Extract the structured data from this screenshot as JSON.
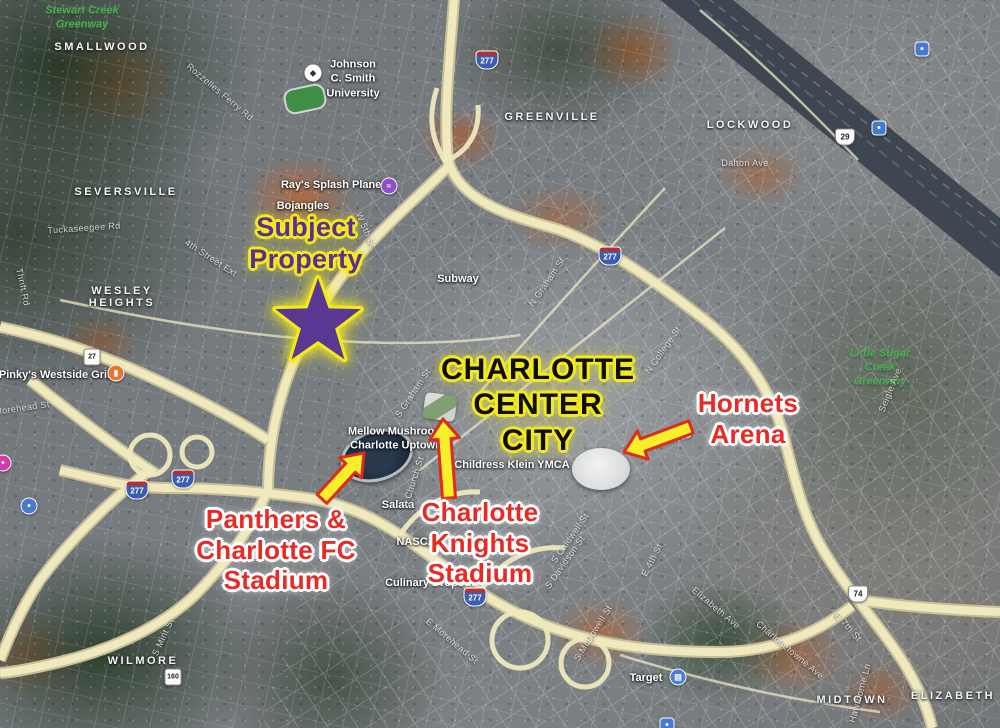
{
  "map_type": "satellite",
  "title_annotations": {
    "subject_property": {
      "text": "Subject\nProperty",
      "color": "#5b2f91",
      "outline": "#f2ea1b"
    },
    "center_city": {
      "text": "CHARLOTTE\nCENTER\nCITY",
      "color": "#0e0e0e",
      "outline": "#f2ea1b"
    },
    "hornets": {
      "text": "Hornets\nArena",
      "color": "#e92a24",
      "outline": "#ffffff"
    },
    "panthers": {
      "text": "Panthers &\nCharlotte FC\nStadium",
      "color": "#e92a24",
      "outline": "#ffffff"
    },
    "knights": {
      "text": "Charlotte\nKnights\nStadium",
      "color": "#e92a24",
      "outline": "#ffffff"
    },
    "star_color": "#5b3794",
    "arrow_fill": "#f7ef29",
    "arrow_outline": "#dd2b1e"
  },
  "star": {
    "cx": 318,
    "cy": 323,
    "outer": 45,
    "inner": 18
  },
  "arrows": [
    {
      "name": "panthers-arrow",
      "from": [
        322,
        499
      ],
      "to": [
        364,
        453
      ]
    },
    {
      "name": "knights-arrow",
      "from": [
        449,
        498
      ],
      "to": [
        443,
        419
      ]
    },
    {
      "name": "hornets-arrow",
      "from": [
        691,
        427
      ],
      "to": [
        624,
        452
      ]
    }
  ],
  "neighborhoods": [
    {
      "label": "SMALLWOOD",
      "x": 102,
      "y": 47
    },
    {
      "label": "SEVERSVILLE",
      "x": 126,
      "y": 192
    },
    {
      "label": "WESLEY\nHEIGHTS",
      "x": 122,
      "y": 297
    },
    {
      "label": "GREENVILLE",
      "x": 552,
      "y": 117
    },
    {
      "label": "LOCKWOOD",
      "x": 750,
      "y": 125
    },
    {
      "label": "WILMORE",
      "x": 143,
      "y": 661
    },
    {
      "label": "MIDTOWN",
      "x": 852,
      "y": 700
    },
    {
      "label": "ELIZABETH",
      "x": 953,
      "y": 696
    }
  ],
  "parks": [
    {
      "label": "Stewart Creek\nGreenway",
      "x": 82,
      "y": 18
    },
    {
      "label": "Little Sugar\nCreek\nGreenway",
      "x": 880,
      "y": 368
    }
  ],
  "pois": [
    {
      "label": "Johnson\nC. Smith\nUniversity",
      "x": 353,
      "y": 79,
      "icon": "graduation-cap",
      "icon_x": 313,
      "icon_y": 73
    },
    {
      "label": "Ray's Splash Planet",
      "x": 333,
      "y": 185,
      "icon": "swim",
      "icon_x": 389,
      "icon_y": 186
    },
    {
      "label": "Bojangles",
      "x": 303,
      "y": 206
    },
    {
      "label": "Subway",
      "x": 458,
      "y": 279
    },
    {
      "label": "Pinky's Westside Grill",
      "x": 56,
      "y": 375,
      "icon": "restaurant",
      "icon_x": 116,
      "icon_y": 373
    },
    {
      "label": "Mellow Mushroom\nCharlotte Uptown",
      "x": 396,
      "y": 439
    },
    {
      "label": "Childress Klein YMCA",
      "x": 512,
      "y": 465
    },
    {
      "label": "Salata",
      "x": 398,
      "y": 505
    },
    {
      "label": "NASCAR",
      "x": 420,
      "y": 542
    },
    {
      "label": "Culinary Dropout",
      "x": 430,
      "y": 583
    },
    {
      "label": "Target",
      "x": 646,
      "y": 678,
      "icon": "shopping",
      "icon_x": 678,
      "icon_y": 677
    }
  ],
  "streets": [
    {
      "label": "Rozzelles Ferry Rd",
      "x": 220,
      "y": 92,
      "rot": 40
    },
    {
      "label": "Tuckaseegee Rd",
      "x": 84,
      "y": 228,
      "rot": -4
    },
    {
      "label": "Thrift Rd",
      "x": 23,
      "y": 287,
      "rot": 78
    },
    {
      "label": "4th Street Ext",
      "x": 211,
      "y": 258,
      "rot": 33
    },
    {
      "label": "W 5th St",
      "x": 366,
      "y": 230,
      "rot": 66
    },
    {
      "label": "N Graham St",
      "x": 547,
      "y": 282,
      "rot": -56
    },
    {
      "label": "S Graham St",
      "x": 413,
      "y": 393,
      "rot": -56
    },
    {
      "label": "N College St",
      "x": 663,
      "y": 350,
      "rot": -55
    },
    {
      "label": "S Church St",
      "x": 413,
      "y": 482,
      "rot": -72
    },
    {
      "label": "Morehead St",
      "x": 22,
      "y": 408,
      "rot": -8
    },
    {
      "label": "S Caldwell St",
      "x": 570,
      "y": 538,
      "rot": -55
    },
    {
      "label": "S Davidson St",
      "x": 565,
      "y": 562,
      "rot": -55
    },
    {
      "label": "E 4th St",
      "x": 652,
      "y": 560,
      "rot": -62
    },
    {
      "label": "S Mint St",
      "x": 163,
      "y": 637,
      "rot": -65
    },
    {
      "label": "E Morehead St",
      "x": 452,
      "y": 641,
      "rot": 40
    },
    {
      "label": "S McDowell St",
      "x": 593,
      "y": 633,
      "rot": -58
    },
    {
      "label": "Elizabeth Ave",
      "x": 716,
      "y": 608,
      "rot": 40
    },
    {
      "label": "Charlottetowne Ave",
      "x": 790,
      "y": 650,
      "rot": 40
    },
    {
      "label": "E 7th St",
      "x": 848,
      "y": 627,
      "rot": 48
    },
    {
      "label": "Hawthorne Ln",
      "x": 860,
      "y": 693,
      "rot": -75
    },
    {
      "label": "Dalton Ave",
      "x": 745,
      "y": 163,
      "rot": 0
    },
    {
      "label": "Seigle Ave",
      "x": 890,
      "y": 390,
      "rot": -68
    },
    {
      "label": "BREVARD",
      "x": 665,
      "y": 442,
      "rot": -16,
      "big": true
    }
  ],
  "shields": [
    {
      "type": "i",
      "label": "277",
      "x": 610,
      "y": 256
    },
    {
      "type": "i",
      "label": "277",
      "x": 137,
      "y": 490
    },
    {
      "type": "i",
      "label": "277",
      "x": 183,
      "y": 479
    },
    {
      "type": "i",
      "label": "277",
      "x": 475,
      "y": 597
    },
    {
      "type": "i",
      "label": "277",
      "x": 487,
      "y": 60
    },
    {
      "type": "us",
      "label": "29",
      "x": 845,
      "y": 137
    },
    {
      "type": "us",
      "label": "74",
      "x": 858,
      "y": 594
    },
    {
      "type": "nc",
      "label": "27",
      "x": 92,
      "y": 357
    },
    {
      "type": "nc",
      "label": "160",
      "x": 173,
      "y": 677
    }
  ],
  "small_icons": [
    {
      "kind": "transit",
      "x": 922,
      "y": 49
    },
    {
      "kind": "transit",
      "x": 879,
      "y": 128
    },
    {
      "kind": "lodging",
      "x": 29,
      "y": 506
    },
    {
      "kind": "pink-poi",
      "x": 3,
      "y": 463
    },
    {
      "kind": "transit-bottom",
      "x": 667,
      "y": 725
    }
  ]
}
